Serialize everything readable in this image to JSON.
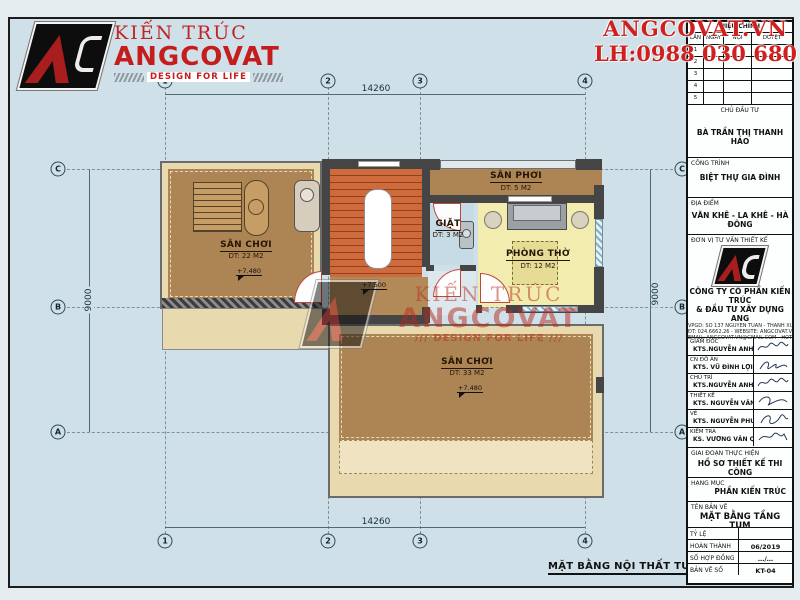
{
  "brand": {
    "pre": "KIẾN TRÚC",
    "name": "ANGCOVAT",
    "tagline": "DESIGN FOR LIFE"
  },
  "contact": {
    "website": "ANGCOVAT.VN",
    "phone": "LH:0988 030 680"
  },
  "colors": {
    "accent_red": "#c51d1d",
    "sheet_bg": "#cfe0e8",
    "floor_brown": "#ad8554",
    "floor_yellow": "#f2edae",
    "floor_blue": "#c6dbe6",
    "stair_orange": "#cf6a3c",
    "terrace_beige": "#e9d9ae",
    "wall_gray": "#454545"
  },
  "plan": {
    "title": "MẶT BẰNG NỘI THẤT TUM",
    "dims": {
      "top": "14260",
      "bottom": "14260",
      "left": "9000",
      "right": "9000"
    },
    "cols": [
      "1",
      "2",
      "3",
      "4"
    ],
    "rows": [
      "C",
      "B",
      "A"
    ],
    "rooms": [
      {
        "name": "SÂN CHƠI",
        "area": "DT: 22 M2",
        "level": "+7.480"
      },
      {
        "name": "SÂN PHƠI",
        "area": "DT: 5 M2"
      },
      {
        "name": "GIẶT",
        "area": "DT: 3 M2"
      },
      {
        "name": "PHÒNG THỜ",
        "area": "DT: 12 M2"
      },
      {
        "name": "SÂN CHƠI",
        "area": "DT: 33 M2",
        "level": "+7.480"
      }
    ],
    "stair_level": "+7.500",
    "watermark": {
      "line1": "KIẾN TRÚC",
      "line2": "ANGCOVAT",
      "line3": "/// DESIGN FOR LIFE ///"
    }
  },
  "titleblock": {
    "revision": {
      "title": "HIỆU CHỈNH",
      "cols": [
        "LẦN",
        "NGÀY",
        "NỘI DUNG",
        "DUYỆT"
      ],
      "rows": [
        "1",
        "2",
        "3",
        "4",
        "5"
      ]
    },
    "client": {
      "label": "CHỦ ĐẦU TƯ",
      "value": "BÀ TRẦN THỊ THANH HẢO"
    },
    "project": {
      "label": "CÔNG TRÌNH",
      "value": "BIỆT THỰ GIA ĐÌNH"
    },
    "location": {
      "label": "ĐỊA ĐIỂM",
      "value": "VĂN KHÊ - LA KHÊ - HÀ ĐÔNG"
    },
    "consultant": {
      "label": "ĐƠN VỊ TƯ VẤN THIẾT KẾ",
      "company_line1": "CÔNG TY CỔ PHẦN KIẾN TRÚC",
      "company_line2": "& ĐẦU TƯ XÂY DỰNG ANG",
      "addr1": "VPGD: SỐ 137 NGUYỄN TUÂN - THANH XUÂN - HÀ NỘI",
      "addr2": "ĐT: 024.6662.26 - WEBSITE: ANGCOVAT.VN",
      "addr3": "EMAIL: ANGCOVAT.VN@GMAIL.COM - HOTLINE: 0988.030.680"
    },
    "signers": [
      {
        "role": "GIÁM ĐỐC",
        "name": "KTS.NGUYỄN ANH TUẤN"
      },
      {
        "role": "CN ĐỒ ÁN",
        "name": "KTS. VŨ ĐÌNH LỢI"
      },
      {
        "role": "CHỦ TRÌ",
        "name": "KTS.NGUYỄN ANH TUẤN"
      },
      {
        "role": "THIẾT KẾ",
        "name": "KTS. NGUYỄN VĂN ĐẠT"
      },
      {
        "role": "VẼ",
        "name": "KTS. NGUYỄN PHƯƠNG HÀ"
      },
      {
        "role": "KIỂM TRA",
        "name": "KS. VƯƠNG VĂN QUÂN"
      }
    ],
    "stage": {
      "label": "GIAI ĐOẠN THỰC HIỆN",
      "value": "HỒ SƠ THIẾT KẾ THI CÔNG"
    },
    "category": {
      "label": "HẠNG MỤC",
      "value": "PHẦN KIẾN TRÚC"
    },
    "sheet": {
      "label": "TÊN BẢN VẼ",
      "value": "MẶT BẰNG TẦNG TUM"
    },
    "meta": [
      {
        "label": "TỶ LỆ",
        "value": ""
      },
      {
        "label": "HOÀN THÀNH",
        "value": "06/2019"
      },
      {
        "label": "SỐ HỢP ĐỒNG",
        "value": "…/…"
      },
      {
        "label": "BẢN VẼ SỐ",
        "value": "KT-04"
      }
    ]
  }
}
